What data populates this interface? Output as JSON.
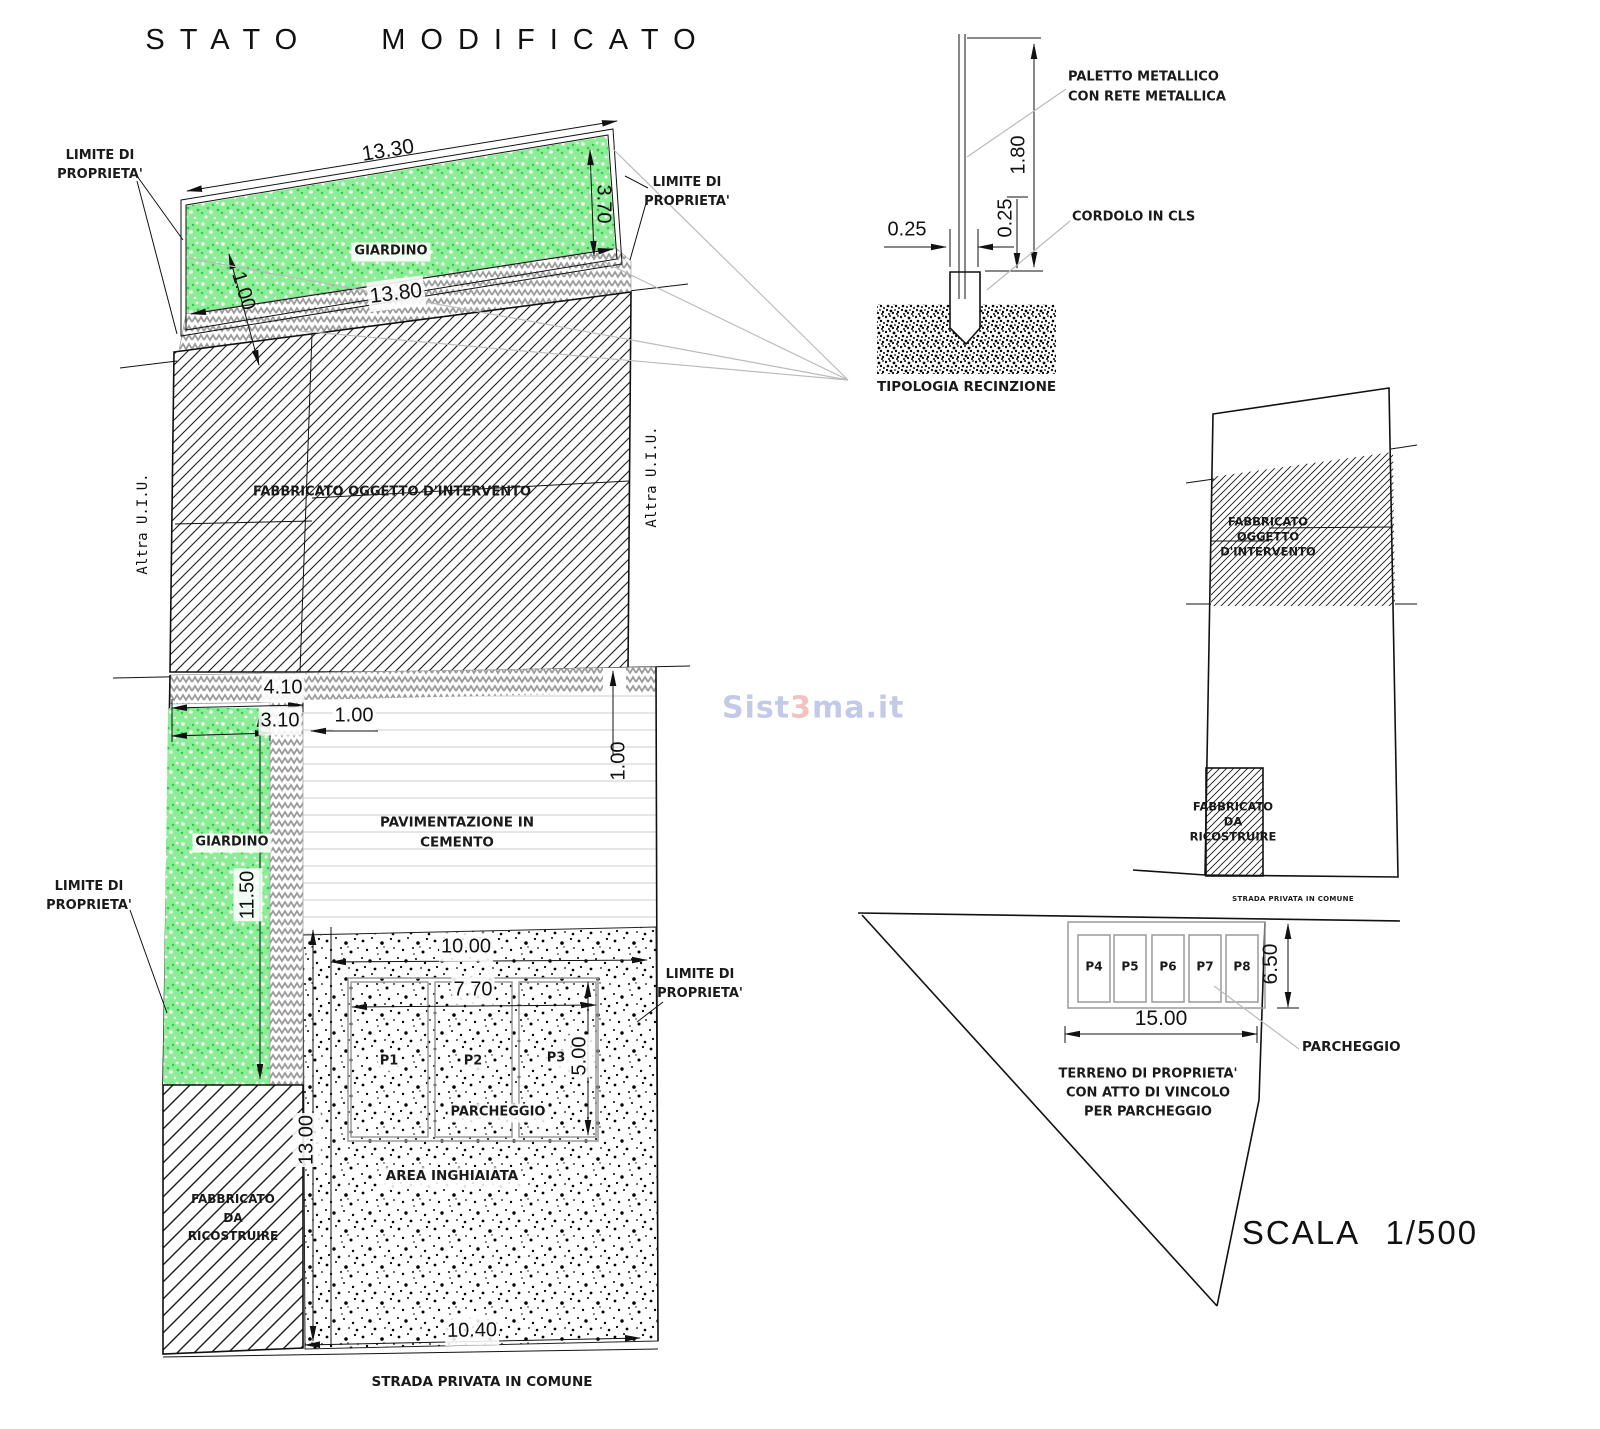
{
  "title": "STATO MODIFICATO",
  "watermark": {
    "s1": "Sist",
    "s2": "3",
    "s3": "ma.it"
  },
  "plan": {
    "limite_line1": "LIMITE DI",
    "limite_line2": "PROPRIETA'",
    "giardino": "GIARDINO",
    "fabbricato_intervento": "FABBRICATO OGGETTO D'INTERVENTO",
    "altra_uiu": "Altra U.I.U.",
    "pavimentazione_line1": "PAVIMENTAZIONE IN",
    "pavimentazione_line2": "CEMENTO",
    "parcheggio": "PARCHEGGIO",
    "area_inghiaiata": "AREA INGHIAIATA",
    "fabbricato_ric_line1": "FABBRICATO",
    "fabbricato_ric_line2": "DA",
    "fabbricato_ric_line3": "RICOSTRUIRE",
    "strada": "STRADA PRIVATA IN COMUNE",
    "stalls": [
      "P1",
      "P2",
      "P3"
    ],
    "dims": {
      "top_width": "13.30",
      "top_height": "3.70",
      "top_offset": "1.00",
      "band": "13.80",
      "d410": "4.10",
      "d310": "3.10",
      "d100a": "1.00",
      "d100b": "1.00",
      "d1150": "11.50",
      "d1000": "10.00",
      "d770": "7.70",
      "d500": "5.00",
      "d1300": "13.00",
      "d1040": "10.40"
    }
  },
  "fence": {
    "paletto_line1": "PALETTO METALLICO",
    "paletto_line2": "CON RETE METALLICA",
    "cordolo": "CORDOLO IN CLS",
    "caption": "TIPOLOGIA RECINZIONE",
    "dims": {
      "height": "1.80",
      "w1": "0.25",
      "w2": "0.25"
    }
  },
  "overview": {
    "fabbricato_int_line1": "FABBRICATO",
    "fabbricato_int_line2": "OGGETTO",
    "fabbricato_int_line3": "D'INTERVENTO",
    "fabbricato_ric_line1": "FABBRICATO",
    "fabbricato_ric_line2": "DA",
    "fabbricato_ric_line3": "RICOSTRUIRE",
    "strada": "STRADA PRIVATA IN COMUNE",
    "stalls": [
      "P4",
      "P5",
      "P6",
      "P7",
      "P8"
    ],
    "parcheggio": "PARCHEGGIO",
    "terreno_line1": "TERRENO DI PROPRIETA'",
    "terreno_line2": "CON ATTO DI VINCOLO",
    "terreno_line3": "PER PARCHEGGIO",
    "dims": {
      "d650": "6.50",
      "d1500": "15.00"
    },
    "scala": "SCALA 1/500"
  },
  "colors": {
    "grass": "#8ced97",
    "grass_dot": "#35c94b",
    "herringbone": "#9c9c9c",
    "hatch": "#1b1b1b",
    "gray_leader": "#bbbbbb",
    "watermark_blue": "#aeb8e2",
    "watermark_red": "#edb0ac"
  }
}
